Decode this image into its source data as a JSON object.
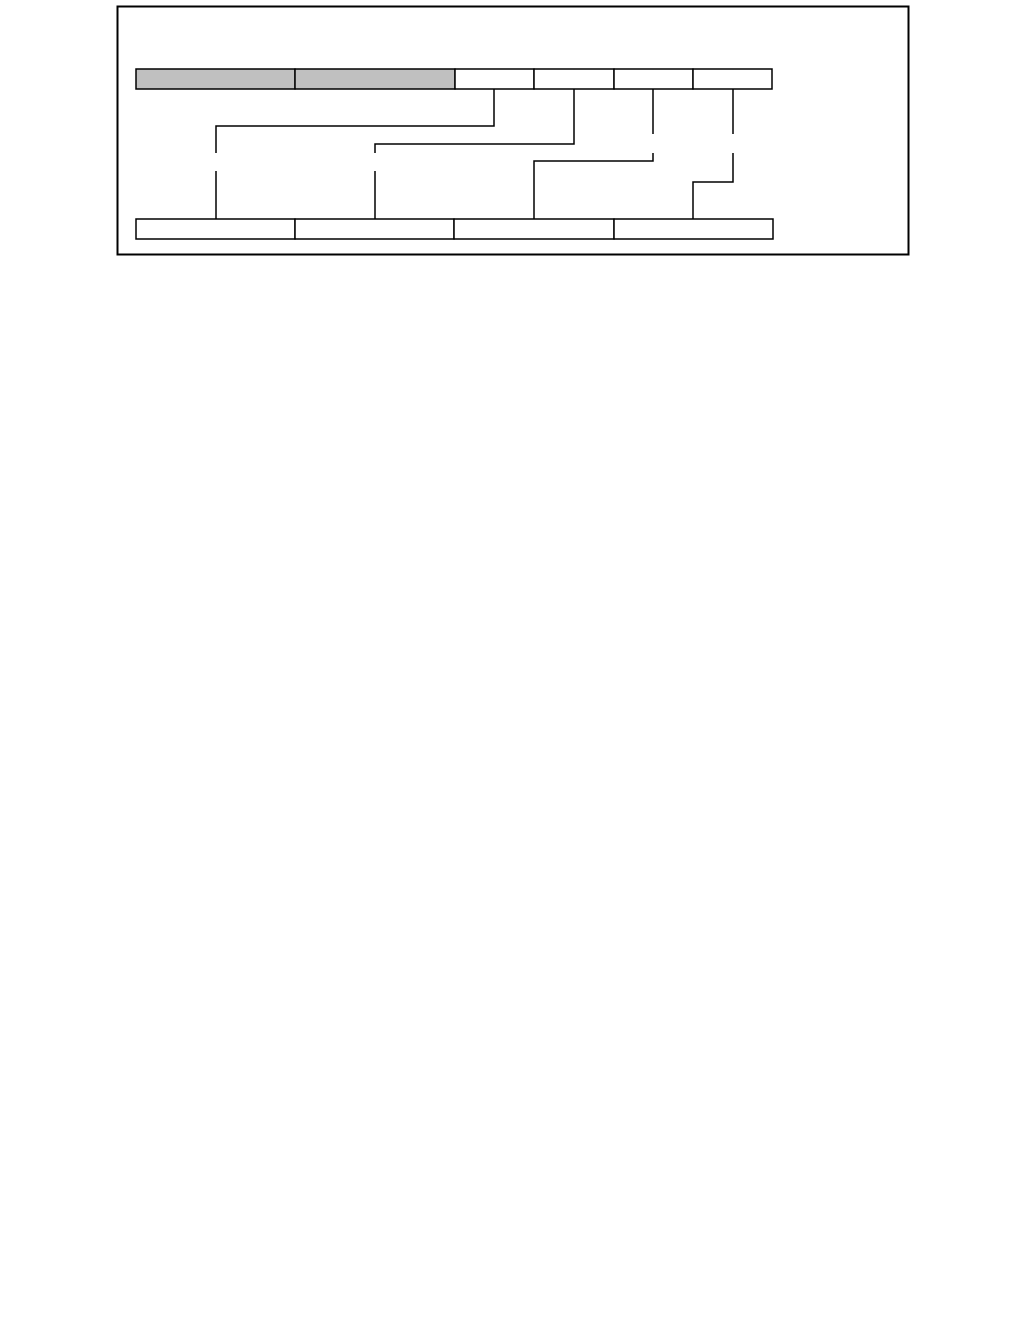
{
  "page": {
    "width": 1029,
    "height": 1343,
    "background_color": "#FFFFFF"
  },
  "figure": {
    "frame": {
      "x": 117.5,
      "y": 6.5,
      "width": 791,
      "height": 248,
      "border_color": "#000000",
      "border_width": 2,
      "fill": "#FFFFFF"
    },
    "colors": {
      "shaded_cell_fill": "#C0C0C0",
      "plain_cell_fill": "#FFFFFF",
      "cell_border": "#000000",
      "connector_line": "#000000"
    },
    "top_row": {
      "y": 69,
      "height": 20,
      "cells": [
        {
          "x": 136,
          "width": 159,
          "shaded": true,
          "label": ""
        },
        {
          "x": 295,
          "width": 160,
          "shaded": true,
          "label": ""
        },
        {
          "x": 455,
          "width": 79,
          "shaded": false,
          "label": ""
        },
        {
          "x": 534,
          "width": 80,
          "shaded": false,
          "label": ""
        },
        {
          "x": 614,
          "width": 79,
          "shaded": false,
          "label": ""
        },
        {
          "x": 693,
          "width": 79,
          "shaded": false,
          "label": ""
        }
      ]
    },
    "bottom_row": {
      "y": 219,
      "height": 20,
      "cells": [
        {
          "x": 136,
          "width": 159,
          "shaded": false,
          "label": ""
        },
        {
          "x": 295,
          "width": 159,
          "shaded": false,
          "label": ""
        },
        {
          "x": 454,
          "width": 160,
          "shaded": false,
          "label": ""
        },
        {
          "x": 614,
          "width": 159,
          "shaded": false,
          "label": ""
        }
      ]
    },
    "connectors": [
      {
        "name": "top-cell-3-to-bottom-cell-1",
        "segments": [
          [
            [
              494,
              89
            ],
            [
              494,
              126
            ],
            [
              216,
              126
            ],
            [
              216,
              153
            ]
          ],
          [
            [
              216,
              171
            ],
            [
              216,
              219
            ]
          ]
        ]
      },
      {
        "name": "top-cell-4-to-bottom-cell-2",
        "segments": [
          [
            [
              574,
              89
            ],
            [
              574,
              144
            ],
            [
              375,
              144
            ],
            [
              375,
              153
            ]
          ],
          [
            [
              375,
              171
            ],
            [
              375,
              219
            ]
          ]
        ]
      },
      {
        "name": "top-cell-5-to-bottom-cell-3",
        "segments": [
          [
            [
              653,
              89
            ],
            [
              653,
              134
            ]
          ],
          [
            [
              653,
              153
            ],
            [
              653,
              161
            ],
            [
              534,
              161
            ],
            [
              534,
              219
            ]
          ]
        ]
      },
      {
        "name": "top-cell-6-to-bottom-cell-4",
        "segments": [
          [
            [
              733,
              89
            ],
            [
              733,
              134
            ]
          ],
          [
            [
              733,
              153
            ],
            [
              733,
              182
            ],
            [
              693,
              182
            ],
            [
              693,
              219
            ]
          ]
        ]
      }
    ],
    "line_width": 1.5
  }
}
